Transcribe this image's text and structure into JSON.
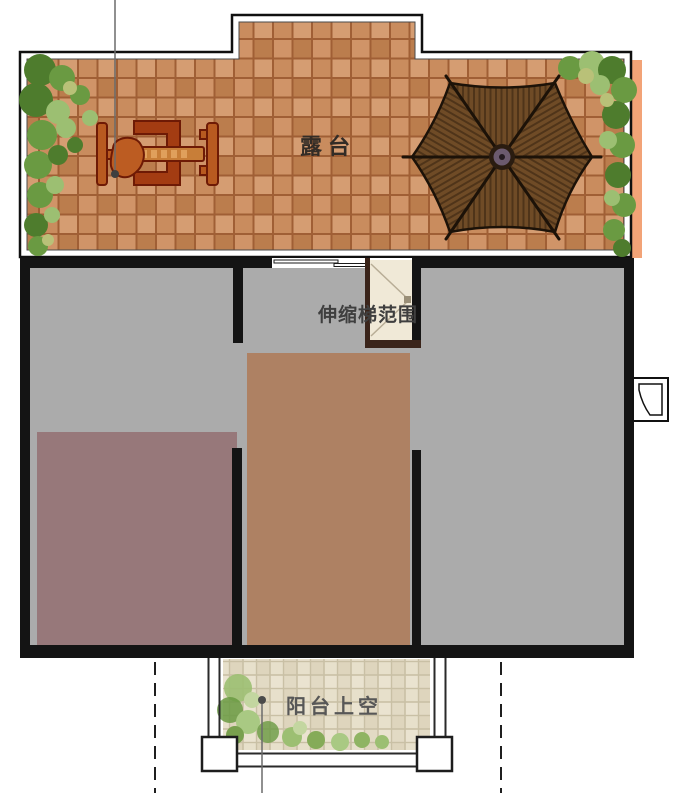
{
  "plan": {
    "title": "second-floor roof terrace plan",
    "labels": {
      "terrace": "露台",
      "ladder_zone": "伸缩梯范围",
      "balcony_void": "阳台上空"
    },
    "icons": {
      "pavilion": "hexagonal-umbrella-pavilion-icon",
      "table_set": "outdoor-table-set-icon",
      "flue": "flue-vent-icon",
      "planting": "shrub-planting-icon"
    },
    "colors": {
      "wall": "#141414",
      "floor_gray": "#ababab",
      "room_mauve": "#97787a",
      "room_brown": "#ae8163",
      "well_fill": "#f0e9d7",
      "well_wood": "#3a241a",
      "terrace_tile": "#cd9164",
      "terrace_grout": "#a05f35",
      "terrace_shadow": "#f2a377",
      "balcony_tile": "#eae3d0",
      "balcony_grout": "#c9c0a5",
      "greenery_dark": "#4e7c2d",
      "greenery_mid": "#6a9a42",
      "greenery_light": "#9cbf72",
      "pavilion_wood": "#6f4b26",
      "pavilion_dark": "#1c1208",
      "furniture_fill": "#b85a20",
      "furniture_stroke": "#6e1a05",
      "label_dark": "#332c26",
      "label_mid": "#3f3f3f",
      "label_light": "#575757",
      "leader": "#6b6b6b"
    }
  }
}
